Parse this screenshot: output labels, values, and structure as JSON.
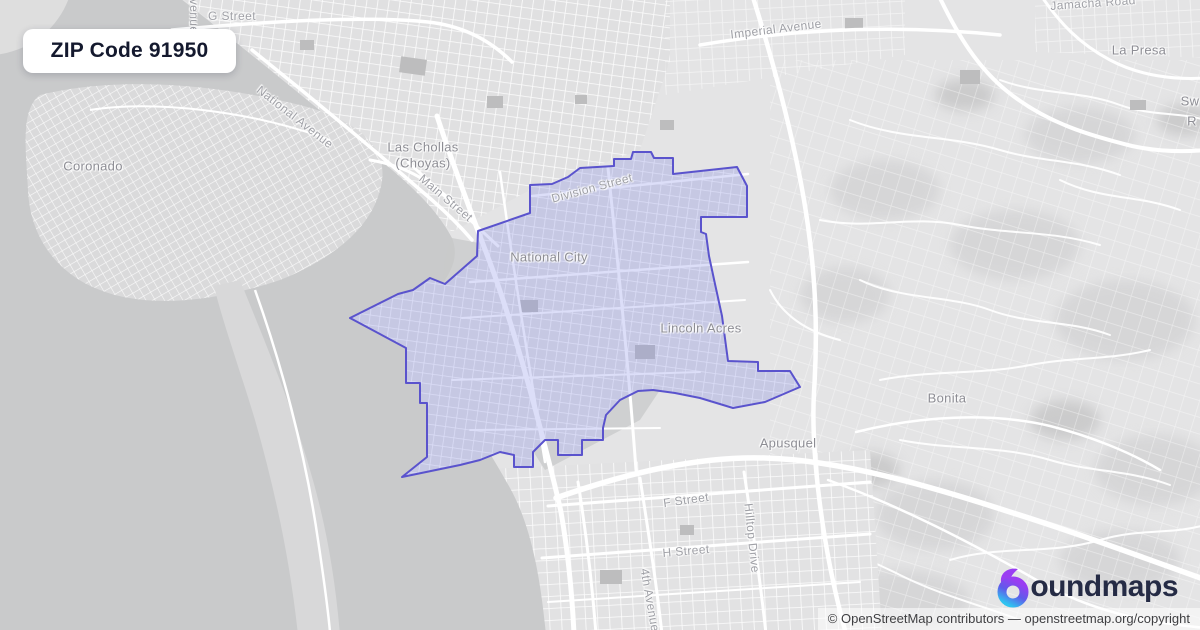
{
  "badge": {
    "title": "ZIP Code 91950"
  },
  "logo": {
    "brand": "boundmaps",
    "brand_rest": "oundmaps",
    "icon": "boundmaps-drop-icon",
    "gradient": [
      "#9a3df2",
      "#5f5bea",
      "#2fc4f0"
    ],
    "text_color": "#252b45"
  },
  "attribution": {
    "text": "© OpenStreetMap contributors — openstreetmap.org/copyright"
  },
  "map": {
    "colors": {
      "water": "#c9cacb",
      "land": "#e4e4e5",
      "roads": "#ffffff",
      "zip_fill": "rgba(127,133,228,0.27)",
      "zip_stroke": "#5a53cd",
      "place_label": "#8d8d94",
      "street_label": "#9fa0a6"
    },
    "boundary_points": "530,213 530,185 552,184 568,177 580,168 614,166 614,159 631,159 633,152 651,152 654,158 673,158 673,174 737,167 747,186 747,217 701,217 701,232 706,234 709,256 715,284 722,316 728,361 758,362 758,371 790,371 800,387 765,402 733,408 700,398 675,393 653,390 638,391 620,400 606,415 603,428 603,440 582,440 582,455 558,455 558,440 545,440 533,452 533,467 514,467 514,455 500,452 480,460 460,465 402,477 427,457 427,403 420,403 420,383 406,383 406,348 350,318 398,294 413,290 430,278 445,284 477,256 478,231",
    "labels": [
      {
        "text": "G Street"
      },
      {
        "text": "Avenue"
      },
      {
        "text": "Imperial Avenue"
      },
      {
        "text": "Jamacha Road"
      },
      {
        "text": "La Presa"
      },
      {
        "text": "Coronado"
      },
      {
        "text": "National Avenue"
      },
      {
        "text": "Las Chollas"
      },
      {
        "text": "(Choyas)"
      },
      {
        "text": "Main Street"
      },
      {
        "text": "Division Street"
      },
      {
        "text": "National City"
      },
      {
        "text": "Lincoln Acres"
      },
      {
        "text": "Bonita"
      },
      {
        "text": "Apusquel"
      },
      {
        "text": "F Street"
      },
      {
        "text": "H Street"
      },
      {
        "text": "Hilltop Drive"
      },
      {
        "text": "4th Avenue"
      },
      {
        "text": "Sw"
      },
      {
        "text": "R"
      }
    ]
  }
}
